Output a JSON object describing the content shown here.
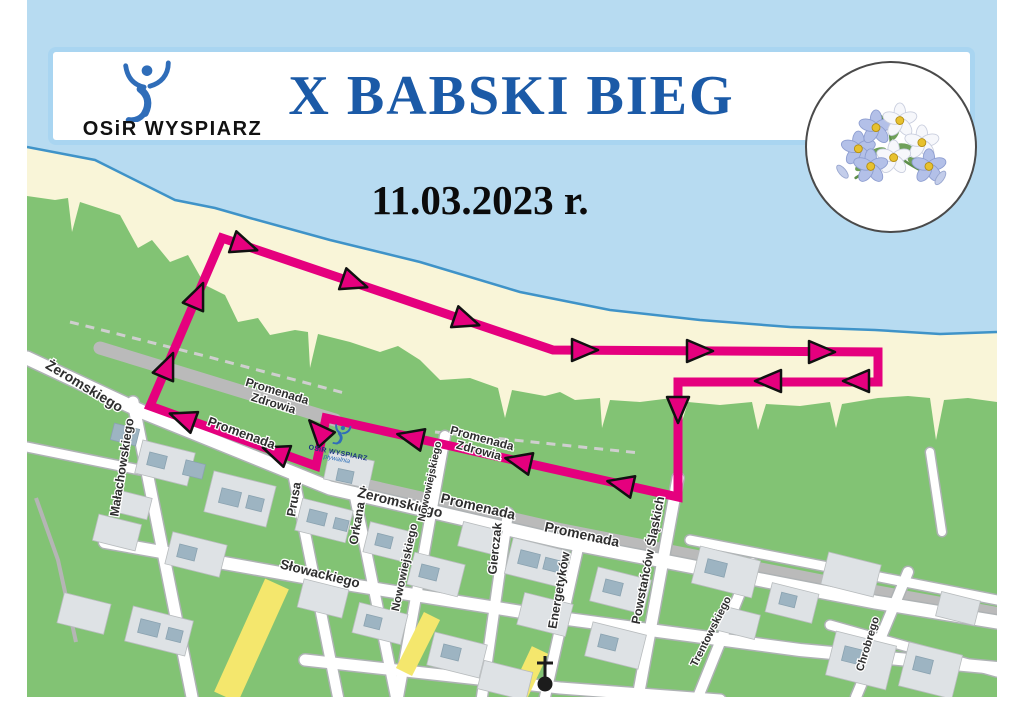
{
  "header": {
    "logo_text": "OSiR WYSPIARZ",
    "title": "X BABSKI BIEG"
  },
  "date_line": "11.03.2023 r.",
  "map_marker": {
    "line1": "OSiR WYSPIARZ",
    "line2": "pływalnia"
  },
  "colors": {
    "header_border": "#a9d5f1",
    "title_blue": "#1b5aa7",
    "logo_blue": "#2f6db9",
    "sea": "#b7dbf1",
    "coast_stroke": "#3f93c8",
    "sand": "#f9f5d8",
    "park_green": "#82c374",
    "road_casing": "#aeb2b4",
    "road_fill": "#ffffff",
    "promenade_gray": "#bababa",
    "building_pale": "#dee2e5",
    "building_slate": "#9db4c2",
    "route_pink": "#e5007e",
    "yellow_road": "#f4e76d",
    "label_color": "#2e2e2e"
  },
  "map": {
    "frame": {
      "x": 27,
      "y": 0,
      "w": 970,
      "h": 697
    },
    "coast_points": [
      [
        27,
        0
      ],
      [
        997,
        0
      ],
      [
        997,
        332
      ],
      [
        940,
        334
      ],
      [
        875,
        330
      ],
      [
        790,
        327
      ],
      [
        700,
        320
      ],
      [
        610,
        310
      ],
      [
        520,
        292
      ],
      [
        420,
        262
      ],
      [
        330,
        240
      ],
      [
        250,
        218
      ],
      [
        215,
        208
      ],
      [
        175,
        200
      ],
      [
        165,
        195
      ],
      [
        95,
        160
      ],
      [
        27,
        147
      ]
    ],
    "green_points": [
      [
        27,
        196
      ],
      [
        55,
        200
      ],
      [
        68,
        198
      ],
      [
        72,
        232
      ],
      [
        80,
        202
      ],
      [
        120,
        215
      ],
      [
        138,
        248
      ],
      [
        152,
        240
      ],
      [
        170,
        262
      ],
      [
        188,
        255
      ],
      [
        205,
        285
      ],
      [
        225,
        295
      ],
      [
        238,
        322
      ],
      [
        258,
        318
      ],
      [
        270,
        335
      ],
      [
        295,
        330
      ],
      [
        308,
        332
      ],
      [
        310,
        368
      ],
      [
        318,
        334
      ],
      [
        350,
        342
      ],
      [
        380,
        352
      ],
      [
        398,
        346
      ],
      [
        420,
        360
      ],
      [
        440,
        380
      ],
      [
        470,
        378
      ],
      [
        498,
        388
      ],
      [
        505,
        418
      ],
      [
        512,
        390
      ],
      [
        545,
        396
      ],
      [
        560,
        392
      ],
      [
        575,
        400
      ],
      [
        600,
        398
      ],
      [
        602,
        428
      ],
      [
        610,
        400
      ],
      [
        640,
        402
      ],
      [
        672,
        398
      ],
      [
        680,
        428
      ],
      [
        688,
        402
      ],
      [
        720,
        405
      ],
      [
        752,
        402
      ],
      [
        758,
        430
      ],
      [
        766,
        404
      ],
      [
        800,
        406
      ],
      [
        830,
        402
      ],
      [
        836,
        428
      ],
      [
        842,
        404
      ],
      [
        878,
        398
      ],
      [
        908,
        396
      ],
      [
        930,
        398
      ],
      [
        936,
        440
      ],
      [
        944,
        400
      ],
      [
        968,
        398
      ],
      [
        997,
        402
      ],
      [
        997,
        697
      ],
      [
        27,
        697
      ]
    ],
    "streets": [
      {
        "pts": [
          [
            27,
            358
          ],
          [
            145,
            413
          ],
          [
            330,
            488
          ],
          [
            560,
            541
          ],
          [
            875,
            602
          ],
          [
            997,
            622
          ]
        ],
        "w": 13
      },
      {
        "pts": [
          [
            27,
            447
          ],
          [
            140,
            470
          ]
        ],
        "w": 9
      },
      {
        "pts": [
          [
            133,
            402
          ],
          [
            192,
            697
          ]
        ],
        "w": 11
      },
      {
        "pts": [
          [
            294,
            478
          ],
          [
            338,
            697
          ]
        ],
        "w": 10
      },
      {
        "pts": [
          [
            354,
            492
          ],
          [
            396,
            697
          ]
        ],
        "w": 10
      },
      {
        "pts": [
          [
            445,
            436
          ],
          [
            398,
            697
          ]
        ],
        "w": 10
      },
      {
        "pts": [
          [
            508,
            513
          ],
          [
            482,
            697
          ]
        ],
        "w": 10
      },
      {
        "pts": [
          [
            578,
            548
          ],
          [
            545,
            697
          ]
        ],
        "w": 10
      },
      {
        "pts": [
          [
            678,
            478
          ],
          [
            638,
            697
          ]
        ],
        "w": 11
      },
      {
        "pts": [
          [
            752,
            563
          ],
          [
            698,
            697
          ]
        ],
        "w": 10
      },
      {
        "pts": [
          [
            908,
            572
          ],
          [
            856,
            697
          ]
        ],
        "w": 10
      },
      {
        "pts": [
          [
            105,
            542
          ],
          [
            320,
            580
          ],
          [
            560,
            618
          ],
          [
            800,
            650
          ],
          [
            997,
            668
          ]
        ],
        "w": 12
      },
      {
        "pts": [
          [
            305,
            660
          ],
          [
            560,
            688
          ],
          [
            720,
            700
          ]
        ],
        "w": 11
      },
      {
        "pts": [
          [
            690,
            540
          ],
          [
            997,
            600
          ]
        ],
        "w": 9
      },
      {
        "pts": [
          [
            930,
            452
          ],
          [
            942,
            532
          ]
        ],
        "w": 8
      },
      {
        "pts": [
          [
            830,
            625
          ],
          [
            997,
            672
          ]
        ],
        "w": 9
      }
    ],
    "promenades": [
      {
        "pts": [
          [
            100,
            348
          ],
          [
            335,
            420
          ]
        ],
        "w": 13
      },
      {
        "pts": [
          [
            340,
            478
          ],
          [
            560,
            528
          ],
          [
            875,
            590
          ],
          [
            997,
            612
          ]
        ],
        "w": 10
      }
    ],
    "dashed_paths": [
      {
        "pts": [
          [
            70,
            322
          ],
          [
            205,
            356
          ],
          [
            348,
            394
          ]
        ]
      },
      {
        "pts": [
          [
            435,
            432
          ],
          [
            640,
            453
          ]
        ]
      }
    ],
    "footpaths": [
      {
        "pts": [
          [
            36,
            498
          ],
          [
            58,
            560
          ],
          [
            76,
            642
          ]
        ]
      }
    ],
    "yellow_segments": [
      {
        "pts": [
          [
            277,
            584
          ],
          [
            226,
            697
          ]
        ],
        "w": 26
      },
      {
        "pts": [
          [
            432,
            616
          ],
          [
            404,
            672
          ]
        ],
        "w": 18
      },
      {
        "pts": [
          [
            540,
            650
          ],
          [
            518,
            697
          ]
        ],
        "w": 18
      }
    ],
    "buildings": [
      [
        112,
        426,
        26,
        17,
        14,
        "s"
      ],
      [
        138,
        446,
        54,
        34,
        14,
        "p"
      ],
      [
        148,
        454,
        18,
        13,
        14,
        "s"
      ],
      [
        184,
        462,
        20,
        15,
        14,
        "s"
      ],
      [
        116,
        494,
        34,
        22,
        14,
        "p"
      ],
      [
        208,
        478,
        64,
        42,
        14,
        "p"
      ],
      [
        220,
        490,
        20,
        15,
        14,
        "s"
      ],
      [
        247,
        497,
        16,
        13,
        14,
        "s"
      ],
      [
        95,
        519,
        44,
        27,
        14,
        "p"
      ],
      [
        168,
        538,
        56,
        33,
        14,
        "p"
      ],
      [
        178,
        546,
        18,
        13,
        14,
        "s"
      ],
      [
        60,
        598,
        48,
        31,
        14,
        "p"
      ],
      [
        128,
        613,
        62,
        36,
        14,
        "p"
      ],
      [
        139,
        621,
        20,
        14,
        14,
        "s"
      ],
      [
        167,
        629,
        15,
        12,
        14,
        "s"
      ],
      [
        298,
        504,
        52,
        33,
        14,
        "p"
      ],
      [
        308,
        511,
        18,
        13,
        14,
        "s"
      ],
      [
        334,
        519,
        14,
        11,
        14,
        "s"
      ],
      [
        366,
        527,
        48,
        31,
        14,
        "p"
      ],
      [
        376,
        535,
        16,
        12,
        14,
        "s"
      ],
      [
        410,
        558,
        52,
        33,
        14,
        "p"
      ],
      [
        420,
        566,
        18,
        13,
        14,
        "s"
      ],
      [
        300,
        584,
        46,
        29,
        14,
        "p"
      ],
      [
        355,
        608,
        50,
        31,
        14,
        "p"
      ],
      [
        365,
        616,
        16,
        12,
        14,
        "s"
      ],
      [
        430,
        638,
        54,
        34,
        14,
        "p"
      ],
      [
        442,
        646,
        18,
        13,
        14,
        "s"
      ],
      [
        460,
        526,
        40,
        25,
        14,
        "p"
      ],
      [
        508,
        544,
        58,
        37,
        14,
        "p"
      ],
      [
        519,
        552,
        20,
        14,
        14,
        "s"
      ],
      [
        544,
        559,
        16,
        12,
        14,
        "s"
      ],
      [
        593,
        573,
        55,
        35,
        14,
        "p"
      ],
      [
        604,
        581,
        18,
        13,
        14,
        "s"
      ],
      [
        520,
        598,
        50,
        33,
        14,
        "p"
      ],
      [
        588,
        628,
        55,
        35,
        14,
        "p"
      ],
      [
        599,
        636,
        18,
        13,
        14,
        "s"
      ],
      [
        480,
        666,
        50,
        29,
        14,
        "p"
      ],
      [
        695,
        553,
        62,
        38,
        14,
        "p"
      ],
      [
        706,
        561,
        20,
        14,
        14,
        "s"
      ],
      [
        718,
        610,
        40,
        25,
        14,
        "p"
      ],
      [
        768,
        588,
        48,
        30,
        14,
        "p"
      ],
      [
        780,
        594,
        16,
        12,
        14,
        "s"
      ],
      [
        824,
        558,
        54,
        33,
        14,
        "p"
      ],
      [
        830,
        638,
        62,
        45,
        14,
        "p"
      ],
      [
        843,
        648,
        20,
        15,
        14,
        "s"
      ],
      [
        903,
        648,
        55,
        45,
        14,
        "p"
      ],
      [
        914,
        658,
        18,
        14,
        14,
        "s"
      ],
      [
        938,
        596,
        40,
        25,
        14,
        "p"
      ],
      [
        326,
        456,
        46,
        28,
        12,
        "p"
      ],
      [
        337,
        470,
        16,
        12,
        12,
        "s"
      ]
    ],
    "labels": [
      {
        "text": "Żeromskiego",
        "x": 82,
        "y": 390,
        "rot": 31,
        "size": 14
      },
      {
        "text": "Małachowskiego",
        "x": 126,
        "y": 468,
        "rot": -81,
        "size": 12.5
      },
      {
        "text": "Prusa",
        "x": 298,
        "y": 500,
        "rot": -80,
        "size": 12.5
      },
      {
        "text": "Orkana",
        "x": 361,
        "y": 524,
        "rot": -80,
        "size": 12.5
      },
      {
        "text": "Żeromskiego",
        "x": 399,
        "y": 507,
        "rot": 14,
        "size": 14
      },
      {
        "text": "Nowowiejskiego",
        "x": 433,
        "y": 482,
        "rot": -78,
        "size": 10.5
      },
      {
        "text": "Nowowiejskiego",
        "x": 408,
        "y": 568,
        "rot": -78,
        "size": 11.5
      },
      {
        "text": "Promenada",
        "x": 240,
        "y": 437,
        "rot": 20,
        "size": 13
      },
      {
        "text": "Promenada",
        "x": 477,
        "y": 511,
        "rot": 13,
        "size": 14
      },
      {
        "text": "Promenada",
        "x": 581,
        "y": 539,
        "rot": 12,
        "size": 14
      },
      {
        "lines": [
          "Promenada",
          "Zdrowia"
        ],
        "x": 276,
        "y": 395,
        "rot": 17,
        "size": 12
      },
      {
        "lines": [
          "Promenada",
          "Zdrowia"
        ],
        "x": 481,
        "y": 442,
        "rot": 15,
        "size": 12
      },
      {
        "text": "Gierczak",
        "x": 499,
        "y": 549,
        "rot": -84,
        "size": 12.5
      },
      {
        "text": "Energetyków",
        "x": 563,
        "y": 591,
        "rot": -80,
        "size": 12.5
      },
      {
        "text": "Powstańców Śląskich",
        "x": 652,
        "y": 561,
        "rot": -79,
        "size": 12.5
      },
      {
        "text": "Słowackiego",
        "x": 319,
        "y": 578,
        "rot": 14,
        "size": 13.5
      },
      {
        "text": "Trentowskiego",
        "x": 714,
        "y": 633,
        "rot": -63,
        "size": 11
      },
      {
        "text": "Chrobrego",
        "x": 871,
        "y": 645,
        "rot": -73,
        "size": 11
      }
    ],
    "route": {
      "width": 9,
      "points": [
        [
          316,
          466
        ],
        [
          150,
          406
        ],
        [
          222,
          238
        ],
        [
          553,
          350
        ],
        [
          878,
          352
        ],
        [
          878,
          382
        ],
        [
          678,
          382
        ],
        [
          678,
          497
        ],
        [
          326,
          418
        ],
        [
          316,
          466
        ]
      ],
      "arrows": [
        [
          245,
          246,
          19
        ],
        [
          355,
          283,
          19
        ],
        [
          467,
          321,
          19
        ],
        [
          585,
          350,
          0
        ],
        [
          700,
          351,
          0
        ],
        [
          822,
          352,
          0
        ],
        [
          856,
          381,
          180
        ],
        [
          768,
          381,
          180
        ],
        [
          678,
          410,
          90
        ],
        [
          620,
          484,
          193
        ],
        [
          518,
          461,
          193
        ],
        [
          410,
          437,
          193
        ],
        [
          318,
          430,
          228
        ],
        [
          275,
          452,
          200
        ],
        [
          182,
          418,
          200
        ],
        [
          168,
          365,
          -67
        ],
        [
          198,
          295,
          -67
        ]
      ]
    },
    "church": {
      "x": 545,
      "y": 684
    }
  }
}
